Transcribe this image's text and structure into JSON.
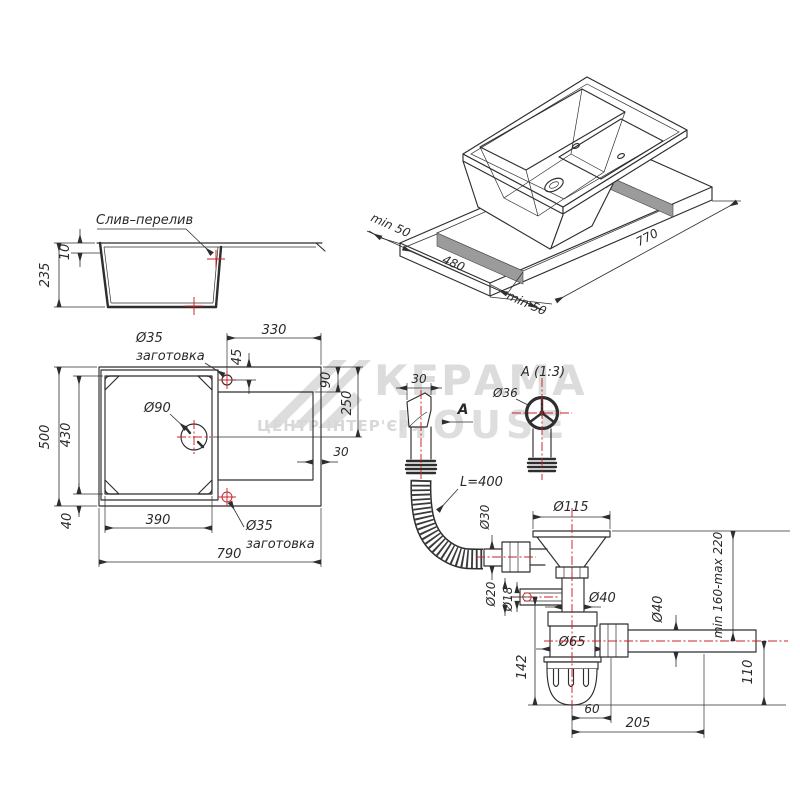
{
  "colors": {
    "background": "#ffffff",
    "line": "#2e2e2e",
    "centerline_red": "#cb2026",
    "cutout_gray": "#9b9b9b",
    "watermark_gray": "#d6d6d6"
  },
  "watermark": {
    "brand_line1": "КЕРАМА",
    "brand_line2": "HOUSE",
    "subtitle": "ЦЕНТР ІНТЕР'ЄРУ"
  },
  "section_view": {
    "callout": "Слив–перелив",
    "depth": "235",
    "rim_thickness": "10"
  },
  "top_view": {
    "drain_diameter": "Ø90",
    "tap_hole_top_diameter": "Ø35",
    "tap_hole_top_note": "заготовка",
    "tap_hole_bottom_diameter": "Ø35",
    "tap_hole_bottom_note": "заготовка",
    "board_width": "330",
    "hole_offset": "45",
    "board_top_offset": "90",
    "drain_center_offset": "250",
    "board_right_gap": "30",
    "overall_width": "790",
    "overall_depth": "500",
    "bowl_width": "390",
    "bowl_depth": "430",
    "bowl_bottom_offset": "40"
  },
  "iso_view": {
    "cutout_length": "770",
    "cutout_depth": "480",
    "margin_left": "min 50",
    "margin_bottom": "min 50"
  },
  "drain_kit": {
    "overflow_width": "30",
    "section_arrow": "A",
    "detail_title": "A (1:3)",
    "overflow_cap_diameter": "Ø36",
    "hose_length": "L=400",
    "hose_connection_diameter": "Ø30",
    "strainer_diameter": "Ø115",
    "inlet_outer_diameter": "Ø20",
    "inlet_inner_diameter": "Ø18",
    "tailpipe_diameter": "Ø40",
    "body_diameter": "Ø65",
    "outlet_diameter": "Ø40",
    "body_height": "142",
    "outlet_height": "110",
    "trap_offset": "60",
    "outlet_length": "205",
    "height_range": "min 160-max 220"
  }
}
